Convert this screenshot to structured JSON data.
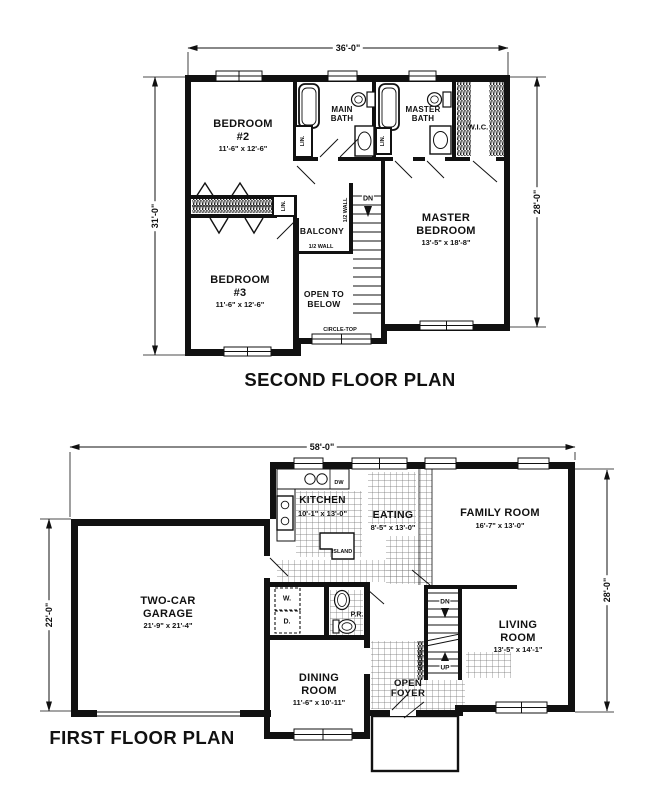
{
  "colors": {
    "ink": "#111111",
    "paper": "#ffffff"
  },
  "second_floor": {
    "title": "SECOND FLOOR PLAN",
    "dim_width": "36'-0\"",
    "dim_left": "31'-0\"",
    "dim_right": "28'-0\"",
    "bedroom2": {
      "name": "BEDROOM",
      "number": "#2",
      "size": "11'-6\" x 12'-6\""
    },
    "bedroom3": {
      "name": "BEDROOM",
      "number": "#3",
      "size": "11'-6\" x 12'-6\""
    },
    "master_bedroom": {
      "line1": "MASTER",
      "line2": "BEDROOM",
      "size": "13'-5\" x 18'-8\""
    },
    "main_bath": {
      "line1": "MAIN",
      "line2": "BATH"
    },
    "master_bath": {
      "line1": "MASTER",
      "line2": "BATH"
    },
    "wic": "W.I.C.",
    "lin": "LIN.",
    "balcony": "BALCONY",
    "half_wall": "1/2 WALL",
    "open_to_below": {
      "line1": "OPEN TO",
      "line2": "BELOW"
    },
    "circle_top": "CIRCLE-TOP",
    "stairs_dn": "DN"
  },
  "first_floor": {
    "title": "FIRST FLOOR PLAN",
    "dim_width": "58'-0\"",
    "dim_left": "22'-0\"",
    "dim_right": "28'-0\"",
    "garage": {
      "line1": "TWO-CAR",
      "line2": "GARAGE",
      "size": "21'-9\" x 21'-4\""
    },
    "kitchen": {
      "name": "KITCHEN",
      "size": "10'-1\" x 13'-0\""
    },
    "eating": {
      "name": "EATING",
      "size": "8'-5\" x 13'-0\""
    },
    "family_room": {
      "name": "FAMILY ROOM",
      "size": "16'-7\" x 13'-0\""
    },
    "living_room": {
      "line1": "LIVING",
      "line2": "ROOM",
      "size": "13'-5\" x 14'-1\""
    },
    "dining_room": {
      "line1": "DINING",
      "line2": "ROOM",
      "size": "11'-6\" x 10'-11\""
    },
    "open_foyer": {
      "line1": "OPEN",
      "line2": "FOYER"
    },
    "powder_room": "P.R.",
    "washer": "W.",
    "dryer": "D.",
    "dishwasher": "DW",
    "island": "ISLAND",
    "stairs_dn": "DN",
    "stairs_up": "UP",
    "railing": "RAILING"
  }
}
